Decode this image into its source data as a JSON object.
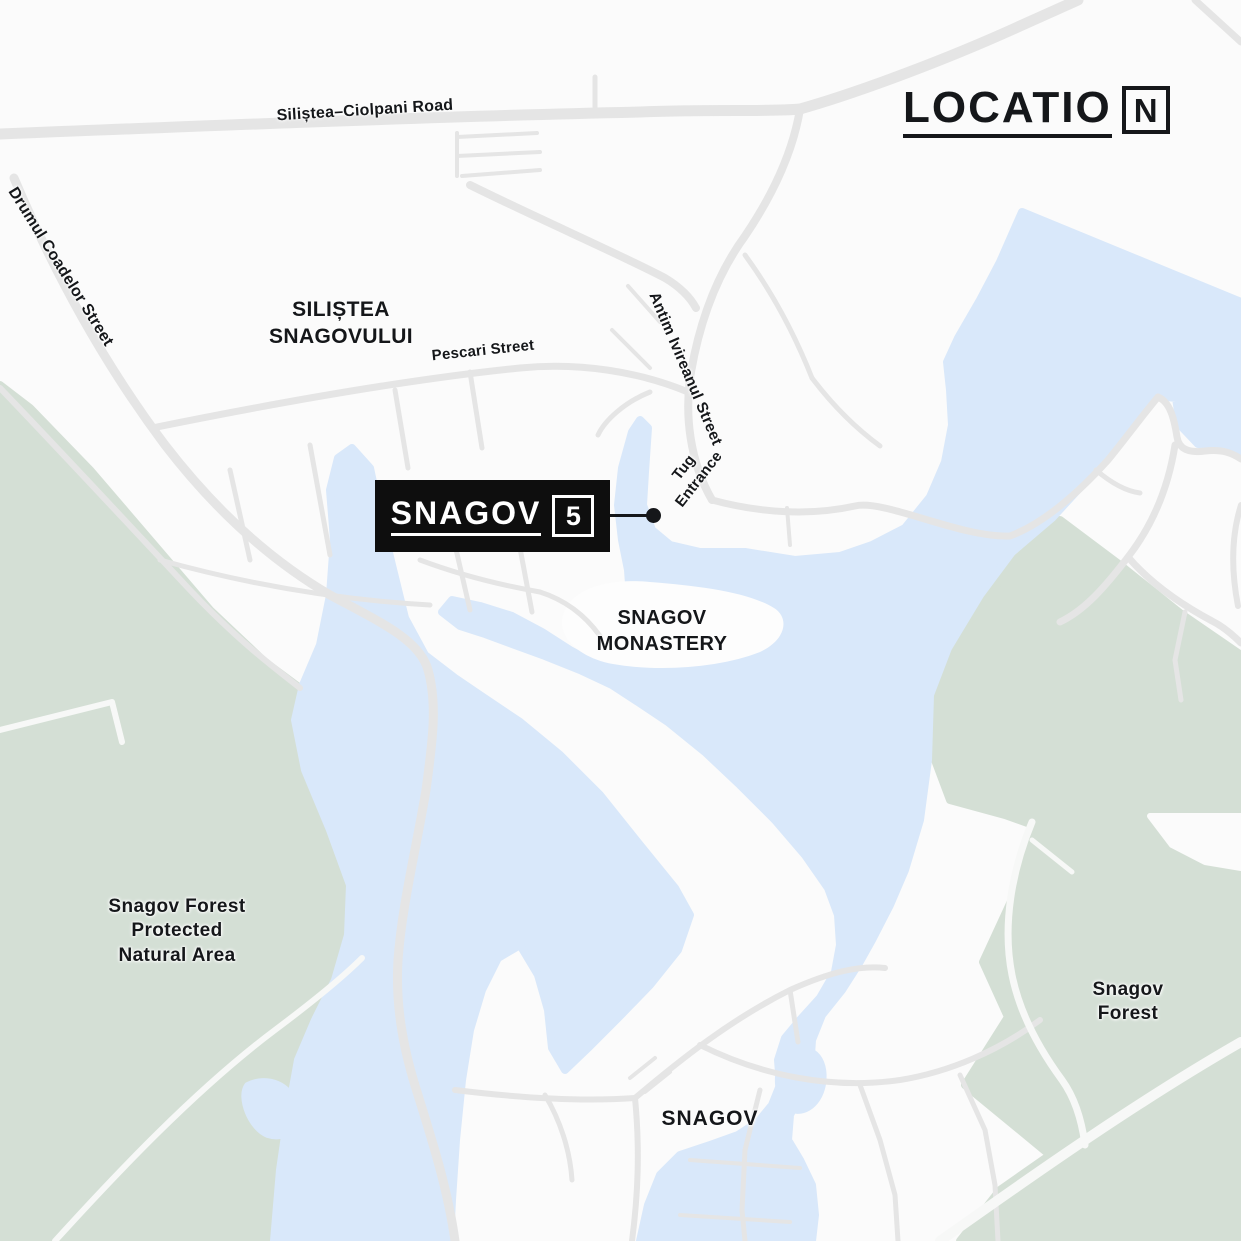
{
  "title": {
    "main": "LOCATIO",
    "boxed_letter": "N"
  },
  "badge": {
    "name": "SNAGOV",
    "number": "5"
  },
  "areas": {
    "silistea": {
      "lines": [
        "SILIȘTEA",
        "SNAGOVULUI"
      ]
    },
    "monastery": {
      "lines": [
        "SNAGOV",
        "MONASTERY"
      ]
    },
    "forest_protected": {
      "lines": [
        "Snagov Forest",
        "Protected",
        "Natural Area"
      ]
    },
    "forest_right": {
      "lines": [
        "Snagov",
        "Forest"
      ]
    },
    "town": {
      "label": "SNAGOV"
    }
  },
  "streets": {
    "ciolpani": "Siliștea–Ciolpani Road",
    "drumul": "Drumul Coadelor Street",
    "pescari": "Pescari Street",
    "antim": "Antim Ivireanul Street",
    "tug": {
      "lines": [
        "Tug",
        "Entrance"
      ]
    }
  },
  "map_features": {
    "lake": "Snagov Lake (unlabeled water body)",
    "island": "Snagov Monastery island"
  },
  "theme": {
    "background": "#fbfbfb",
    "water": "#d9e8fa",
    "forest": "#d4dfd5",
    "road": "#e5e5e5",
    "road_light": "#f7f8f7",
    "ink": "#15171a",
    "badge_bg": "#0e0e0e",
    "badge_fg": "#ffffff"
  }
}
